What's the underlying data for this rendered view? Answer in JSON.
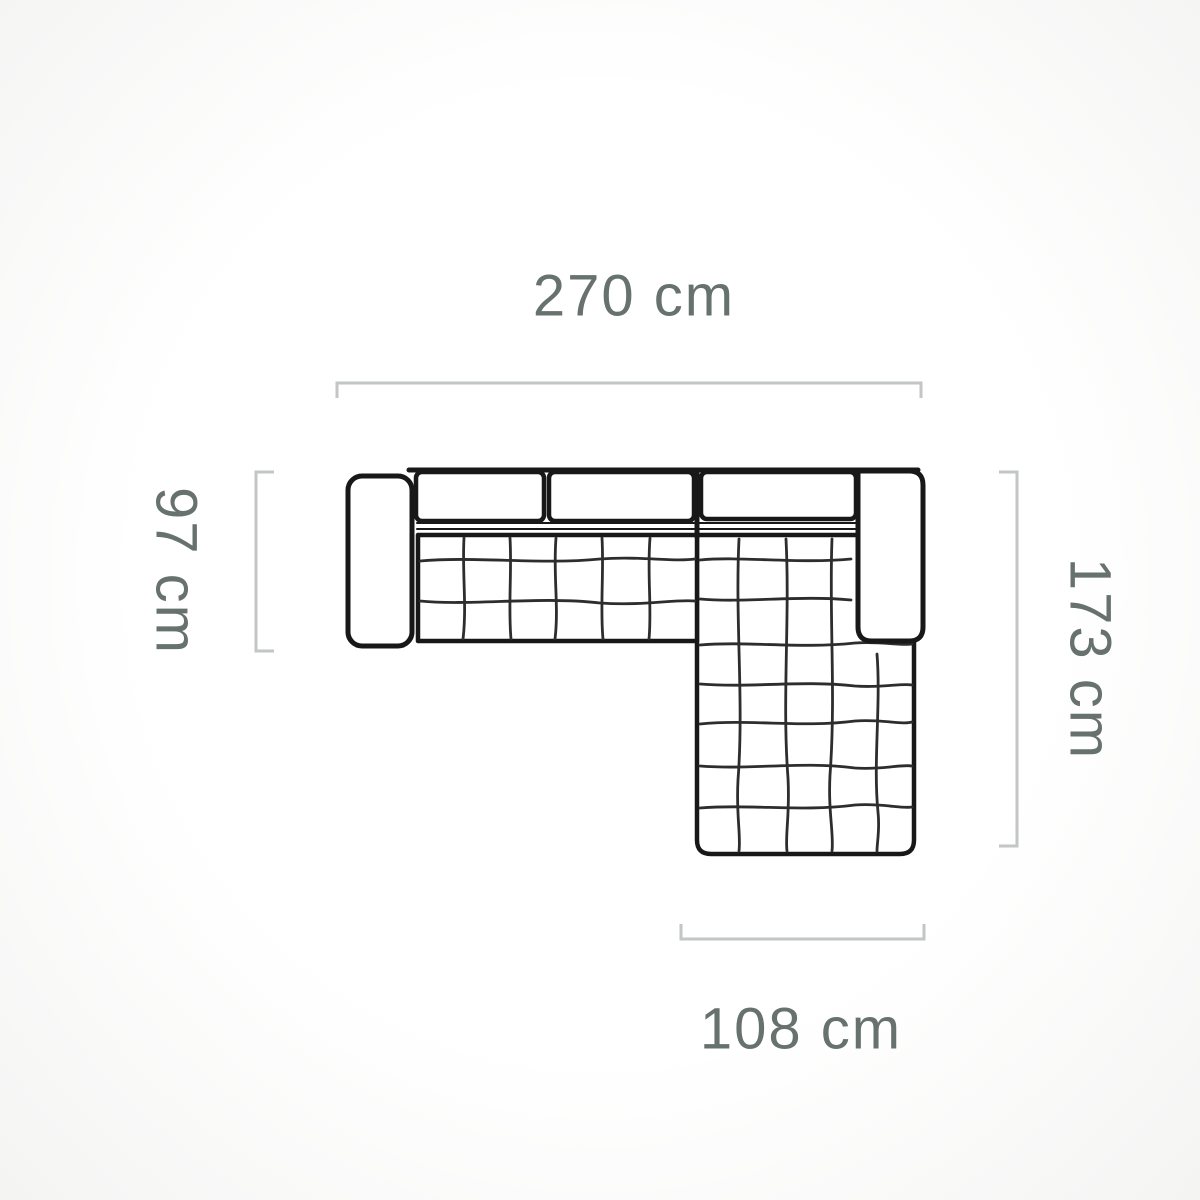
{
  "diagram": {
    "kind": "corner-sofa-top-view-dimension-diagram",
    "unit": "cm",
    "dimensions": {
      "top": {
        "label": "270 cm",
        "value": 270,
        "unit": "cm",
        "side": "overall width"
      },
      "left": {
        "label": "97 cm",
        "value": 97,
        "unit": "cm",
        "side": "sofa depth"
      },
      "right": {
        "label": "173 cm",
        "value": 173,
        "unit": "cm",
        "side": "overall depth with chaise"
      },
      "bottom": {
        "label": "108 cm",
        "value": 108,
        "unit": "cm",
        "side": "chaise width"
      }
    },
    "colors": {
      "outline": "#181818",
      "quilt_line": "#2d2d2d",
      "dimension_line": "#c2c6c5",
      "label_text": "#67716e",
      "sofa_fill": "#ffffff"
    }
  }
}
